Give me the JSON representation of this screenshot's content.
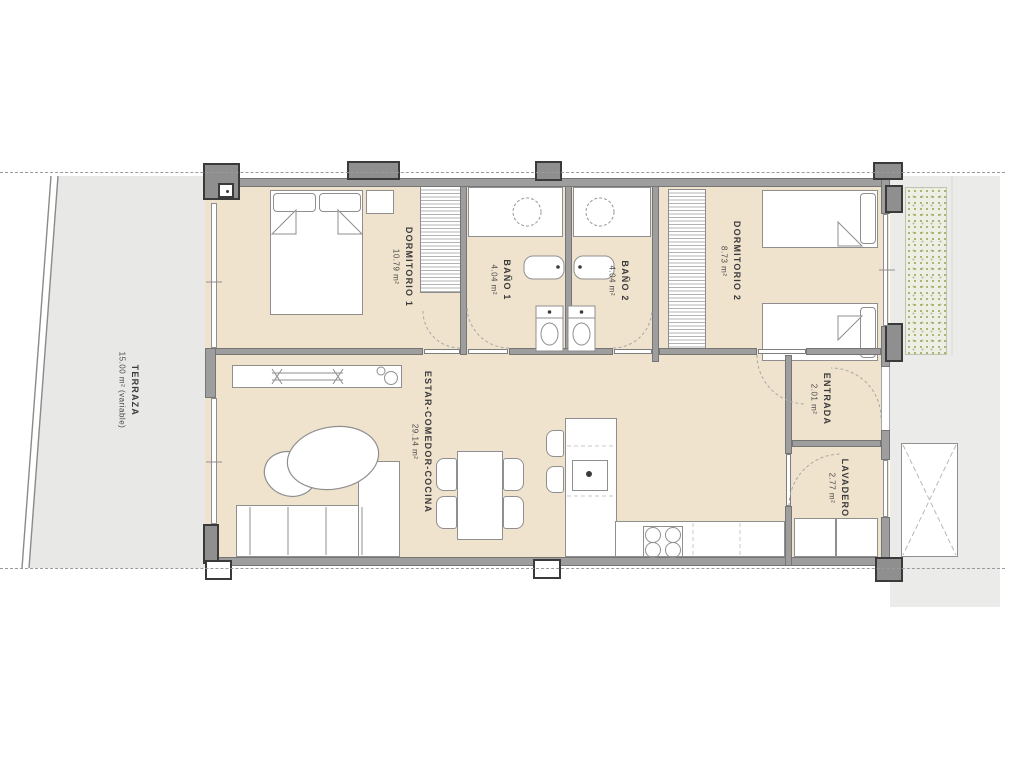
{
  "plan": {
    "rooms": [
      {
        "id": "terraza",
        "name": "TERRAZA",
        "area": "15.00 m² (variable)"
      },
      {
        "id": "dormitorio-1",
        "name": "DORMITORIO 1",
        "area": "10.79 m²"
      },
      {
        "id": "bano-1",
        "name": "BAÑO 1",
        "area": "4.04 m²"
      },
      {
        "id": "bano-2",
        "name": "BAÑO 2",
        "area": "4.04 m²"
      },
      {
        "id": "dormitorio-2",
        "name": "DORMITORIO 2",
        "area": "8.73 m²"
      },
      {
        "id": "estar",
        "name": "ESTAR-COMEDOR-COCINA",
        "area": "29.14 m²"
      },
      {
        "id": "entrada",
        "name": "ENTRADA",
        "area": "2.01 m²"
      },
      {
        "id": "lavadero",
        "name": "LAVADERO",
        "area": "2.77 m²"
      }
    ],
    "colors": {
      "floor_fill": "#f0e3cd",
      "terrace_fill": "#e8e8e6",
      "outdoor_fill": "#ebebea",
      "wall_gray": "#9e9e9e",
      "line_gray": "#8f8f8f",
      "label_text": "#3a3a3a"
    }
  }
}
